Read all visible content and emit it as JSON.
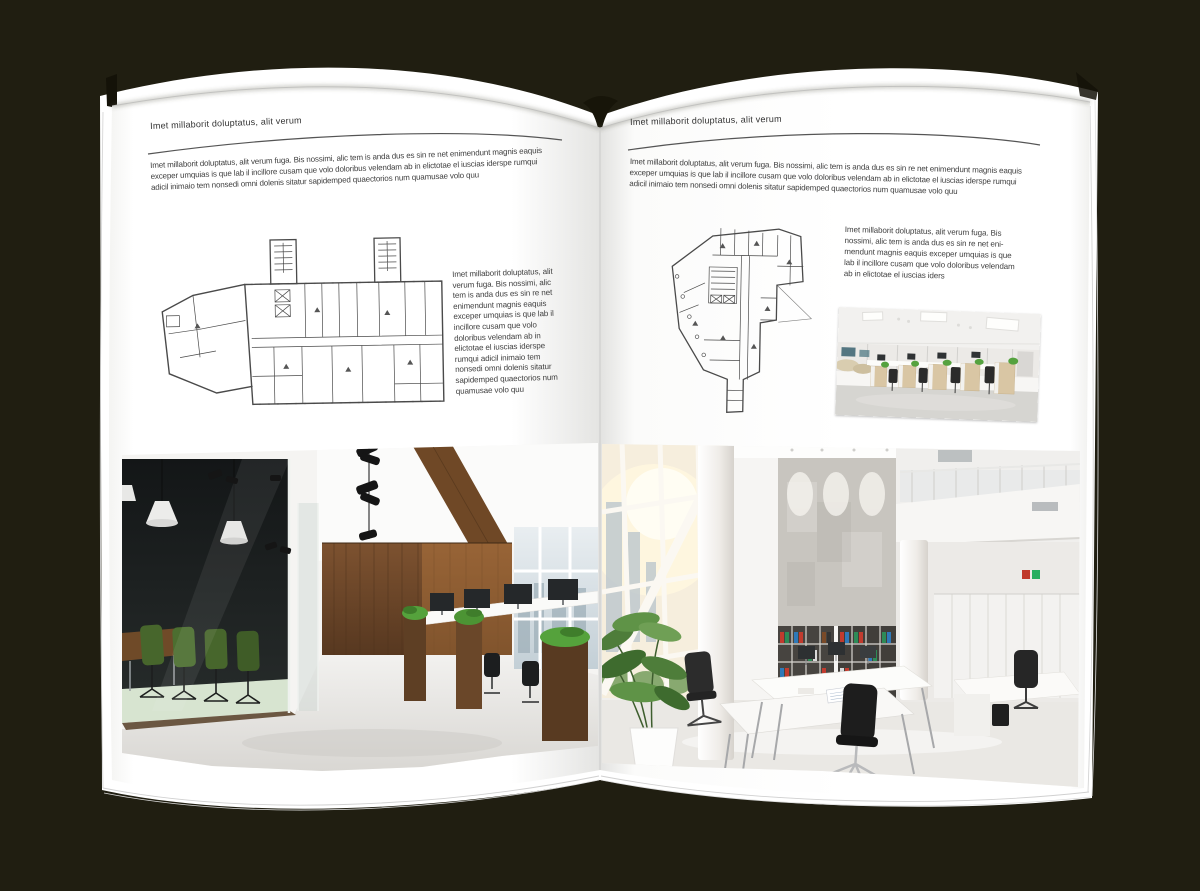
{
  "colors": {
    "background": "#201e11",
    "page": "#ffffff",
    "text": "#3e3e3e",
    "header_text": "#333333",
    "rule": "#555555",
    "plan_line": "#4a4a4a",
    "wood_wall": "#6e4526",
    "chair_green": "#47662c",
    "binder_red": "#c23b2e",
    "binder_green": "#2e8b57",
    "binder_blue": "#2f79b8"
  },
  "left_page": {
    "header": "Imet millaborit doluptatus, alit verum",
    "intro": "Imet millaborit doluptatus, alit verum fuga. Bis nossimi, alic tem is anda dus es sin re net enimendunt magnis eaquis exceper umquias is que lab il incillore cusam que volo doloribus velendam ab in elictotae el iuscias iderspe rumqui adicil inimaio tem nonsedi omni dolenis sitatur sapidemped quaectorios num quamusae volo quu",
    "side_text": "Imet millaborit doluptatus, alit verum fuga. Bis nossimi, alic tem is anda dus es sin re net enimendunt magnis eaquis exceper umquias is que lab il incillore cusam que volo doloribus velendam ab in elictotae el iuscias iderspe rumqui adicil inimaio tem nonsedi omni dolenis sitatur sapidemped quaectorios num quamusae volo quu",
    "images": [
      "architectural-floor-plan",
      "dark-office-interior-photo"
    ]
  },
  "right_page": {
    "header": "Imet millaborit doluptatus, alit verum",
    "intro": "Imet millaborit doluptatus, alit verum fuga. Bis nossimi, alic tem is anda dus es sin re net enimendunt magnis eaquis exceper umquias is que lab il incillore cusam que volo doloribus velendam ab in elictotae el iuscias iderspe rumqui adicil inimaio tem nonsedi omni dolenis sitatur sapidemped quaectorios num quamusae volo quu",
    "side_text": "Imet millaborit doluptatus, alit verum fuga. Bis nossimi, alic tem is anda dus es sin re net eni-mendunt magnis eaquis exceper umquias is que lab il incillore cusam que volo doloribus velendam ab in elictotae el iuscias iders",
    "images": [
      "architectural-floor-plan",
      "small-office-interior-photo",
      "bright-office-interior-photo"
    ]
  }
}
